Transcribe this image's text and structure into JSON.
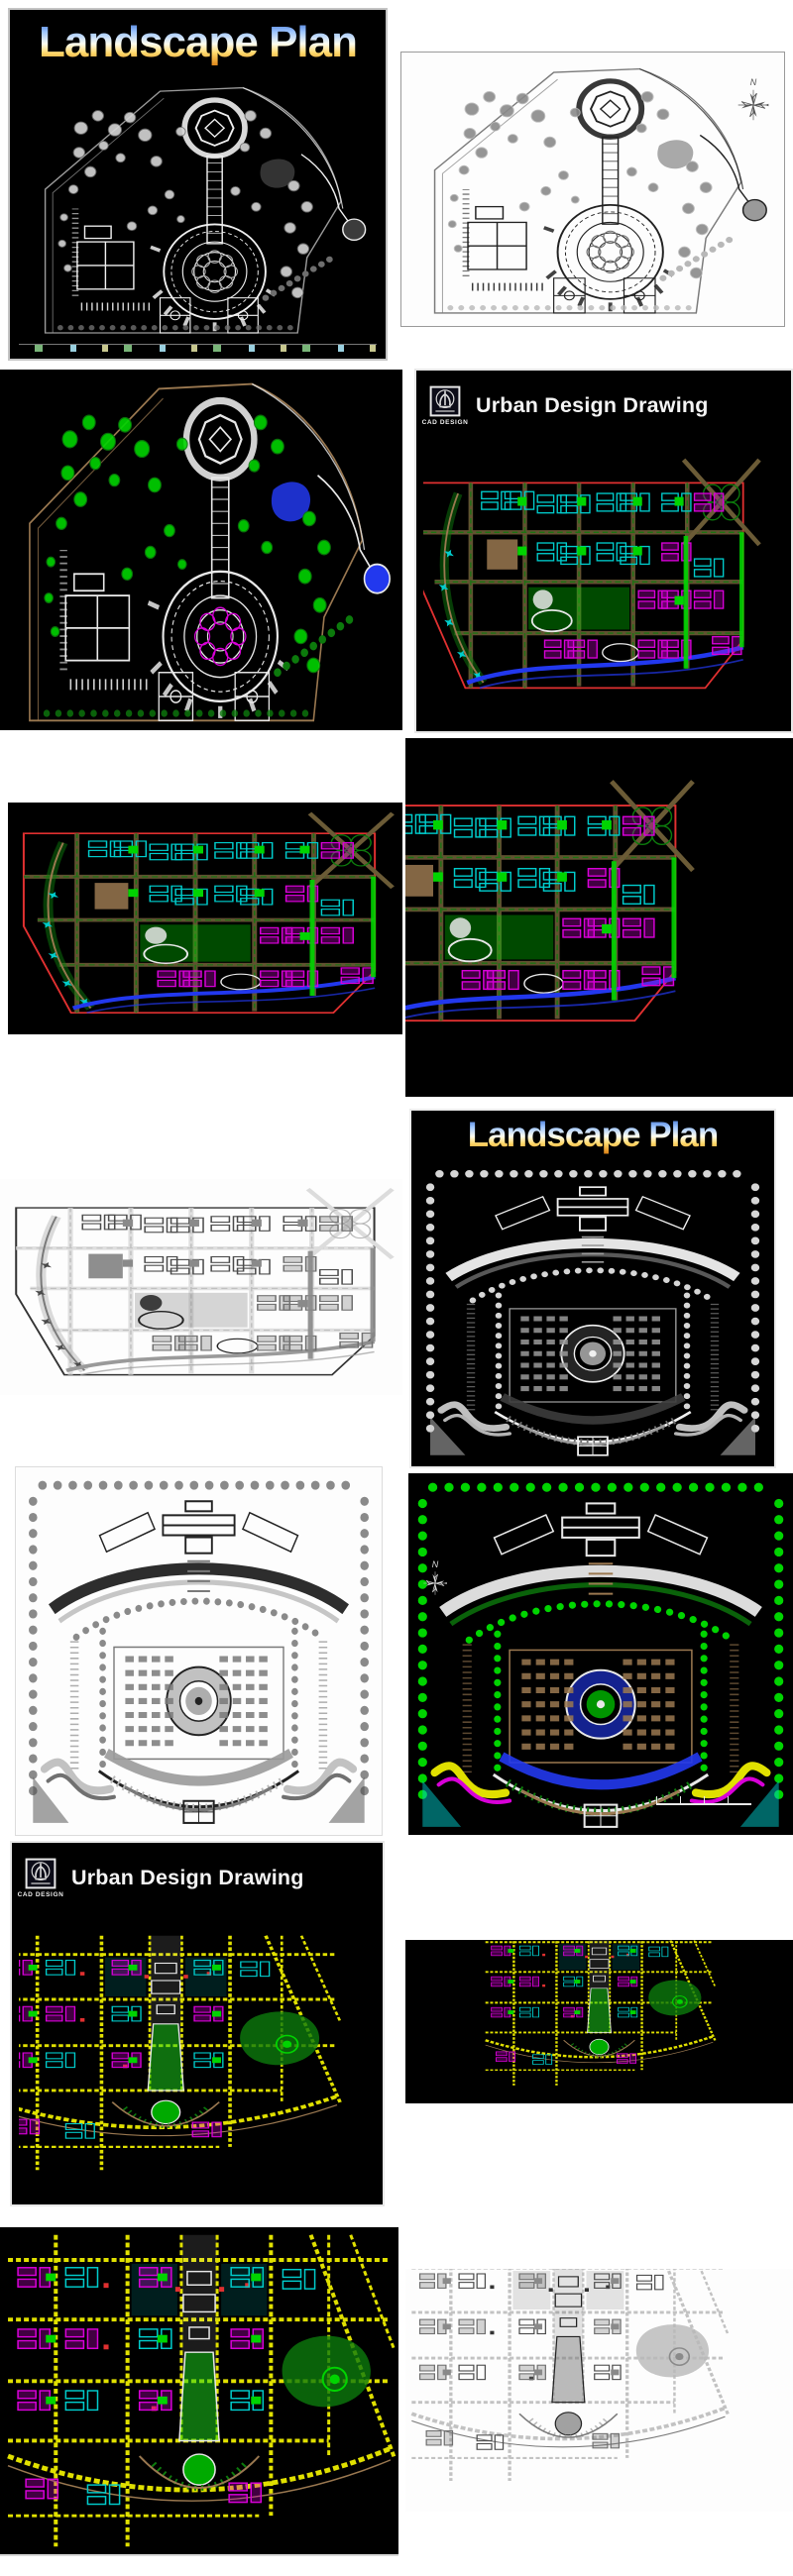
{
  "collage": {
    "background": "#ffffff",
    "tile_count": 14,
    "description": "Vertical collage of CAD landscape and urban design drawings"
  },
  "labels": {
    "landscape_title": "Landscape Plan",
    "urban_title": "Urban Design Drawing",
    "compass_north": "N"
  },
  "colors": {
    "cad_background": "#000000",
    "cad_white_line": "#f0f0f0",
    "paper_white": "#fdfdfd",
    "ink_black": "#222222",
    "tree_green": "#00d400",
    "dark_green": "#0c7a0c",
    "road_yellow": "#e0e000",
    "magenta": "#d800d8",
    "cyan": "#00cccc",
    "red": "#e03030",
    "water_blue": "#2238ee",
    "road_brown": "#6b5b36",
    "title_gradient_blue": "#2f64c8",
    "title_gradient_cream": "#fdfdf0",
    "title_gradient_gold": "#e08a1e"
  },
  "tiles": [
    {
      "id": 1,
      "name": "landscape-plan-park-dark-bw",
      "title": "Landscape Plan",
      "theme": "dark-bw",
      "drawing": "park"
    },
    {
      "id": 2,
      "name": "park-plan-white-line",
      "compass": "N",
      "theme": "paper",
      "drawing": "park"
    },
    {
      "id": 3,
      "name": "park-plan-color-dark",
      "theme": "dark-color",
      "drawing": "park"
    },
    {
      "id": 4,
      "name": "urban-design-drawing-city-grid",
      "title": "Urban Design Drawing",
      "logo": "CAD DESIGN",
      "theme": "dark-color",
      "drawing": "citygrid"
    },
    {
      "id": 5,
      "name": "city-grid-color-dark-wide",
      "theme": "dark-color",
      "drawing": "citygrid"
    },
    {
      "id": 6,
      "name": "city-grid-color-dark-tall",
      "theme": "dark-color",
      "drawing": "citygrid"
    },
    {
      "id": 7,
      "name": "city-grid-white-line",
      "theme": "paper",
      "drawing": "citygrid"
    },
    {
      "id": 8,
      "name": "landscape-plan-plaza-dark-bw",
      "title": "Landscape Plan",
      "theme": "dark-bw",
      "drawing": "plaza"
    },
    {
      "id": 9,
      "name": "plaza-plan-white-line",
      "theme": "paper",
      "drawing": "plaza"
    },
    {
      "id": 10,
      "name": "plaza-plan-color-dark",
      "compass": "N",
      "theme": "dark-color",
      "drawing": "plaza"
    },
    {
      "id": 11,
      "name": "urban-design-drawing-axis-city",
      "title": "Urban Design Drawing",
      "logo": "CAD DESIGN",
      "theme": "dark-color",
      "drawing": "axiscity"
    },
    {
      "id": 12,
      "name": "axis-city-color-wide-crop",
      "theme": "dark-color",
      "drawing": "axiscity"
    },
    {
      "id": 13,
      "name": "axis-city-color-full",
      "theme": "dark-color",
      "drawing": "axiscity"
    },
    {
      "id": 14,
      "name": "axis-city-white-line",
      "theme": "paper",
      "drawing": "axiscity"
    }
  ]
}
